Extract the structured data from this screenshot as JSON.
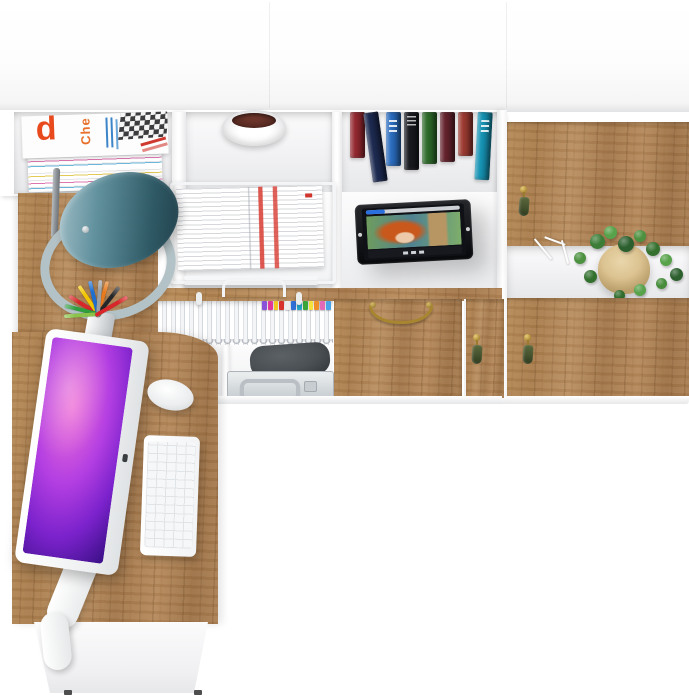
{
  "meta": {
    "description": "Top-down 3D product render of a home office furniture set: white wall unit with oak fronts, corner desk with computer, open shelves with magazines, books, binders, a tablet playing a video, and decor.",
    "background_color": "#ffffff"
  },
  "materials": {
    "oak": "#ab8054",
    "white": "#ffffff",
    "brass": "#a8862f",
    "tassel_green": "#45522e"
  },
  "wall_unit": {
    "magazine_shelf": {
      "item": "stack of magazines",
      "cover_letter": "d",
      "cover_word": "Che",
      "edge_stripe_colors": [
        "#e2c43c",
        "#d9509c",
        "#3fa3d4"
      ]
    },
    "bowl_shelf": {
      "item": "white decorative bowl",
      "contents_color": "#572a22"
    },
    "book_shelf": {
      "item": "row of books",
      "books": [
        {
          "color": "#93282f",
          "h": 46,
          "tilt": 0
        },
        {
          "color": "#1d2a50",
          "h": 70,
          "tilt": -8
        },
        {
          "color": "#2a6cbe",
          "h": 54,
          "tilt": 0
        },
        {
          "color": "#191a20",
          "h": 58,
          "tilt": 0
        },
        {
          "color": "#2e6b2a",
          "h": 52,
          "tilt": 0
        },
        {
          "color": "#64222c",
          "h": 50,
          "tilt": 0
        },
        {
          "color": "#9c3a31",
          "h": 44,
          "tilt": 0
        },
        {
          "color": "#1693b4",
          "h": 68,
          "tilt": 3
        }
      ]
    },
    "binder_shelf": {
      "item": "row of white ring binders",
      "tab_colors": [
        "#8a52d8",
        "#e0389a",
        "#f2c71f",
        "#d8322c",
        "#ededed",
        "#2f6fd6",
        "#27a7c9",
        "#39a53a",
        "#f2e23a",
        "#ef8f2a",
        "#e268b8",
        "#4aa3e8"
      ]
    },
    "storage_shelf": {
      "bag_color": "#4b5054",
      "case_color": "#d9dde0",
      "case_handle_color": "#b9bfc4"
    },
    "drawer": {
      "handle": "brass bow handle",
      "handle_color": "#a8862f"
    },
    "small_door": {
      "handle": "brass knob with green tassel",
      "tassel_color": "#45522e"
    },
    "tablet": {
      "bezel_color": "#17181b",
      "progress_color": "#2a6fe0",
      "video_subject": "red-haired animated character",
      "hair_color": "#c9581c"
    }
  },
  "wardrobe": {
    "upper_door": {
      "material": "oak",
      "handle_color": "#b6933c",
      "tassel_color": "#45522e"
    },
    "plant_shelf": {
      "item": "potted plant with white twig decor",
      "pot_color": "#dcc391",
      "leaves": [
        {
          "x": 50,
          "y": 8,
          "s": 15,
          "c": "#3c7d38"
        },
        {
          "x": 64,
          "y": 0,
          "s": 13,
          "c": "#57a24b"
        },
        {
          "x": 78,
          "y": 10,
          "s": 16,
          "c": "#2c5f2e"
        },
        {
          "x": 94,
          "y": 4,
          "s": 12,
          "c": "#4c9140"
        },
        {
          "x": 106,
          "y": 16,
          "s": 14,
          "c": "#35702f"
        },
        {
          "x": 120,
          "y": 28,
          "s": 12,
          "c": "#57a24b"
        },
        {
          "x": 130,
          "y": 42,
          "s": 13,
          "c": "#2c5f2e"
        },
        {
          "x": 116,
          "y": 52,
          "s": 11,
          "c": "#468c3b"
        },
        {
          "x": 34,
          "y": 26,
          "s": 12,
          "c": "#4c9140"
        },
        {
          "x": 44,
          "y": 44,
          "s": 13,
          "c": "#33702e"
        },
        {
          "x": 94,
          "y": 58,
          "s": 12,
          "c": "#57a24b"
        },
        {
          "x": 74,
          "y": 64,
          "s": 11,
          "c": "#2f6b2b"
        }
      ]
    },
    "lower_door": {
      "material": "oak",
      "handle_color": "#b6933c",
      "tassel_color": "#45522e"
    }
  },
  "desk": {
    "material": "oak",
    "lamp": {
      "shade_color": "#2e5965",
      "base_ring_color": "#b3c2c6"
    },
    "paper_tray": {
      "item": "wire letter tray with documents",
      "stripe_color": "#d0342c"
    },
    "pencil_cup": {
      "pencils": [
        {
          "color": "#d8262a",
          "a": -58
        },
        {
          "color": "#f2c500",
          "a": -34
        },
        {
          "color": "#2f9e3f",
          "a": -76
        },
        {
          "color": "#1f6fd0",
          "a": -14
        },
        {
          "color": "#e87b1e",
          "a": 16
        },
        {
          "color": "#24262a",
          "a": 38
        },
        {
          "color": "#8bc34a",
          "a": -94
        },
        {
          "color": "#9aa0a4",
          "a": 4
        },
        {
          "color": "#d8262a",
          "a": 60
        }
      ]
    },
    "monitor": {
      "frame_color": "#f3f4f5",
      "wallpaper_colors": [
        "#ef6fd6",
        "#7b22cc",
        "#22085a"
      ]
    },
    "keyboard_color": "#f6f7f8",
    "mouse_color": "#fdfdfd"
  }
}
